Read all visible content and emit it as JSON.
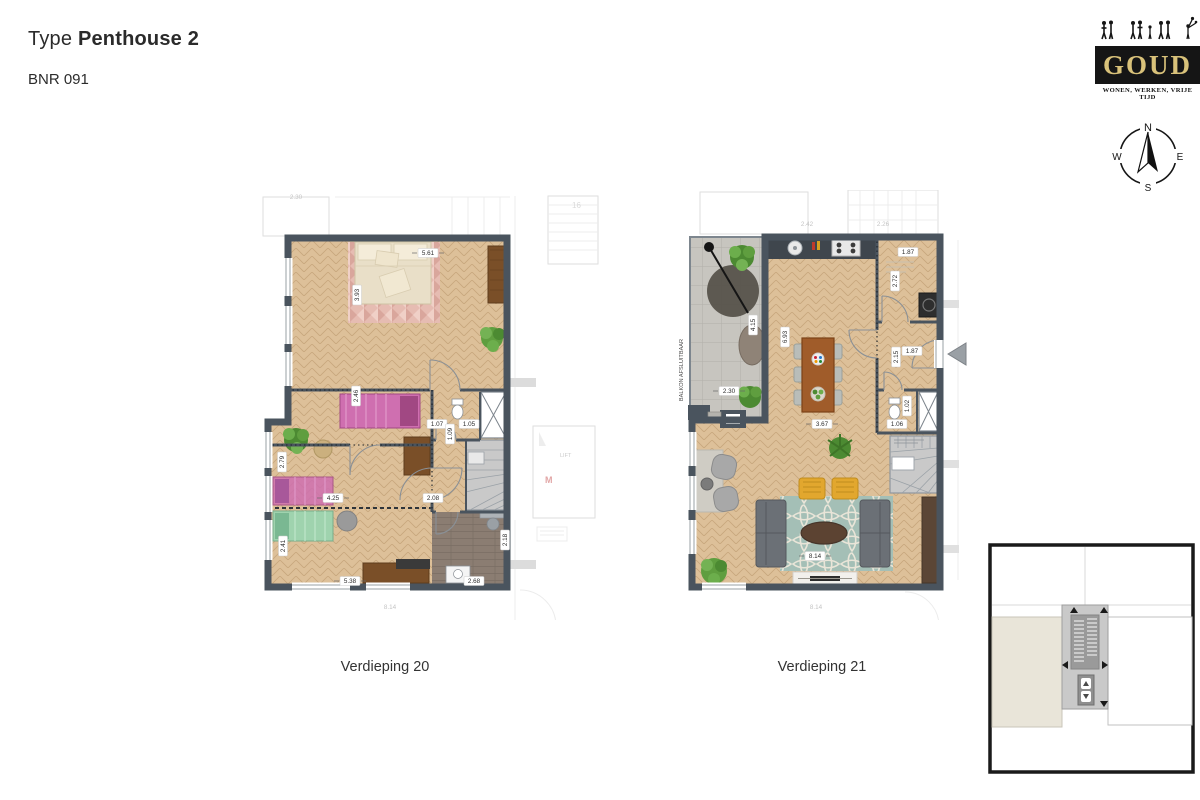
{
  "header": {
    "title_prefix": "Type",
    "title_bold": "Penthouse 2",
    "bnr": "BNR 091"
  },
  "logo": {
    "word": "GOUD",
    "tagline": "WONEN, WERKEN, VRIJE TIJD"
  },
  "compass": {
    "n": "N",
    "e": "E",
    "s": "S",
    "w": "W"
  },
  "plans": {
    "plan20": {
      "caption": "Verdieping 20",
      "context": {
        "lift": "LIFT",
        "marker": "M",
        "floor_ref": "16"
      },
      "dims": [
        "5.61",
        "3.93",
        "2.46",
        "1.07",
        "1.05",
        "1.09",
        "2.79",
        "4.25",
        "2.08",
        "2.41",
        "5.38",
        "2.68",
        "2.18",
        "8.14",
        "2.30"
      ]
    },
    "plan21": {
      "caption": "Verdieping 21",
      "labels": {
        "balcony": "BALKON AFSLUITBAAR",
        "opstap": "OPSTAP"
      },
      "dims": [
        "2.42",
        "2.26",
        "1.87",
        "2.72",
        "4.15",
        "6.93",
        "2.30",
        "2.15",
        "1.87",
        "3.67",
        "1.06",
        "1.02",
        "8.14",
        "8.14"
      ]
    }
  },
  "colors": {
    "wall": "#4a545e",
    "floor": "#ddc099",
    "floorline": "#c7a67c",
    "tilegray": "#c7c5bf",
    "tileline": "#b2b0aa",
    "shower": "#8b7d72",
    "showerline": "#7a6d63",
    "rugpink": "#e6bcb2",
    "rugteal": "#a4bfb6",
    "sofa": "#6b7076",
    "yellow": "#e2a72e",
    "wood": "#a05c2a",
    "wooddark": "#7a4f28",
    "bedcream": "#e9dfc8",
    "bedpink": "#cf6fb0",
    "bedgreen": "#9fd3ae",
    "plant": "#5f9e3f",
    "stairs": "#c9c9c9",
    "gold": "#d9c27a",
    "black": "#151515"
  }
}
